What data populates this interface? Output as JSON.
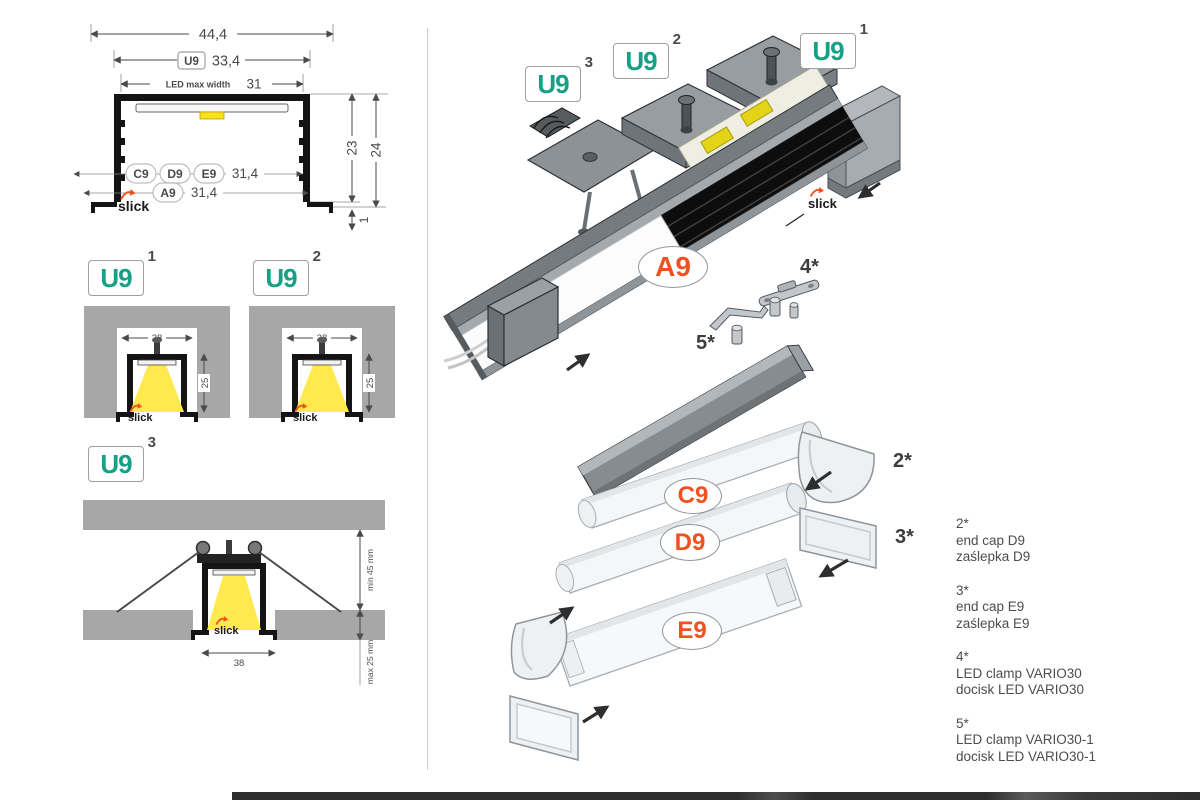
{
  "brand": {
    "slick": "slick"
  },
  "cross_section": {
    "dim_total_width": "44,4",
    "tag_u9": "U9",
    "dim_u9_width": "33,4",
    "led_max_width_label": "LED max width",
    "dim_led_width": "31",
    "dim_inner_height": "23",
    "dim_outer_height": "24",
    "tag_c9": "C9",
    "tag_d9": "D9",
    "tag_e9": "E9",
    "dim_cover_width": "31,4",
    "tag_a9": "A9",
    "dim_a9_width": "31,4",
    "dim_flange": "1"
  },
  "mount1": {
    "tag": "U9",
    "sup": "1",
    "dim_width": "38",
    "dim_depth": "25"
  },
  "mount2": {
    "tag": "U9",
    "sup": "2",
    "dim_width": "38",
    "dim_depth": "25"
  },
  "mount3": {
    "tag": "U9",
    "sup": "3",
    "dim_min": "min 45 mm",
    "dim_max": "max 25 mm",
    "dim_width": "38"
  },
  "exploded": {
    "tag1": {
      "label": "U9",
      "sup": "1"
    },
    "tag2": {
      "label": "U9",
      "sup": "2"
    },
    "tag3": {
      "label": "U9",
      "sup": "3"
    },
    "a9": "A9",
    "c9": "C9",
    "d9": "D9",
    "e9": "E9",
    "ref2": "2*",
    "ref3": "3*",
    "ref4": "4*",
    "ref5": "5*"
  },
  "legend": {
    "items": [
      {
        "ref": "2*",
        "line1": "end cap D9",
        "line2": "zaślepka D9"
      },
      {
        "ref": "3*",
        "line1": "end cap E9",
        "line2": "zaślepka E9"
      },
      {
        "ref": "4*",
        "line1": "LED clamp VARIO30",
        "line2": "docisk LED VARIO30"
      },
      {
        "ref": "5*",
        "line1": "LED clamp VARIO30-1",
        "line2": "docisk LED VARIO30-1"
      }
    ]
  }
}
